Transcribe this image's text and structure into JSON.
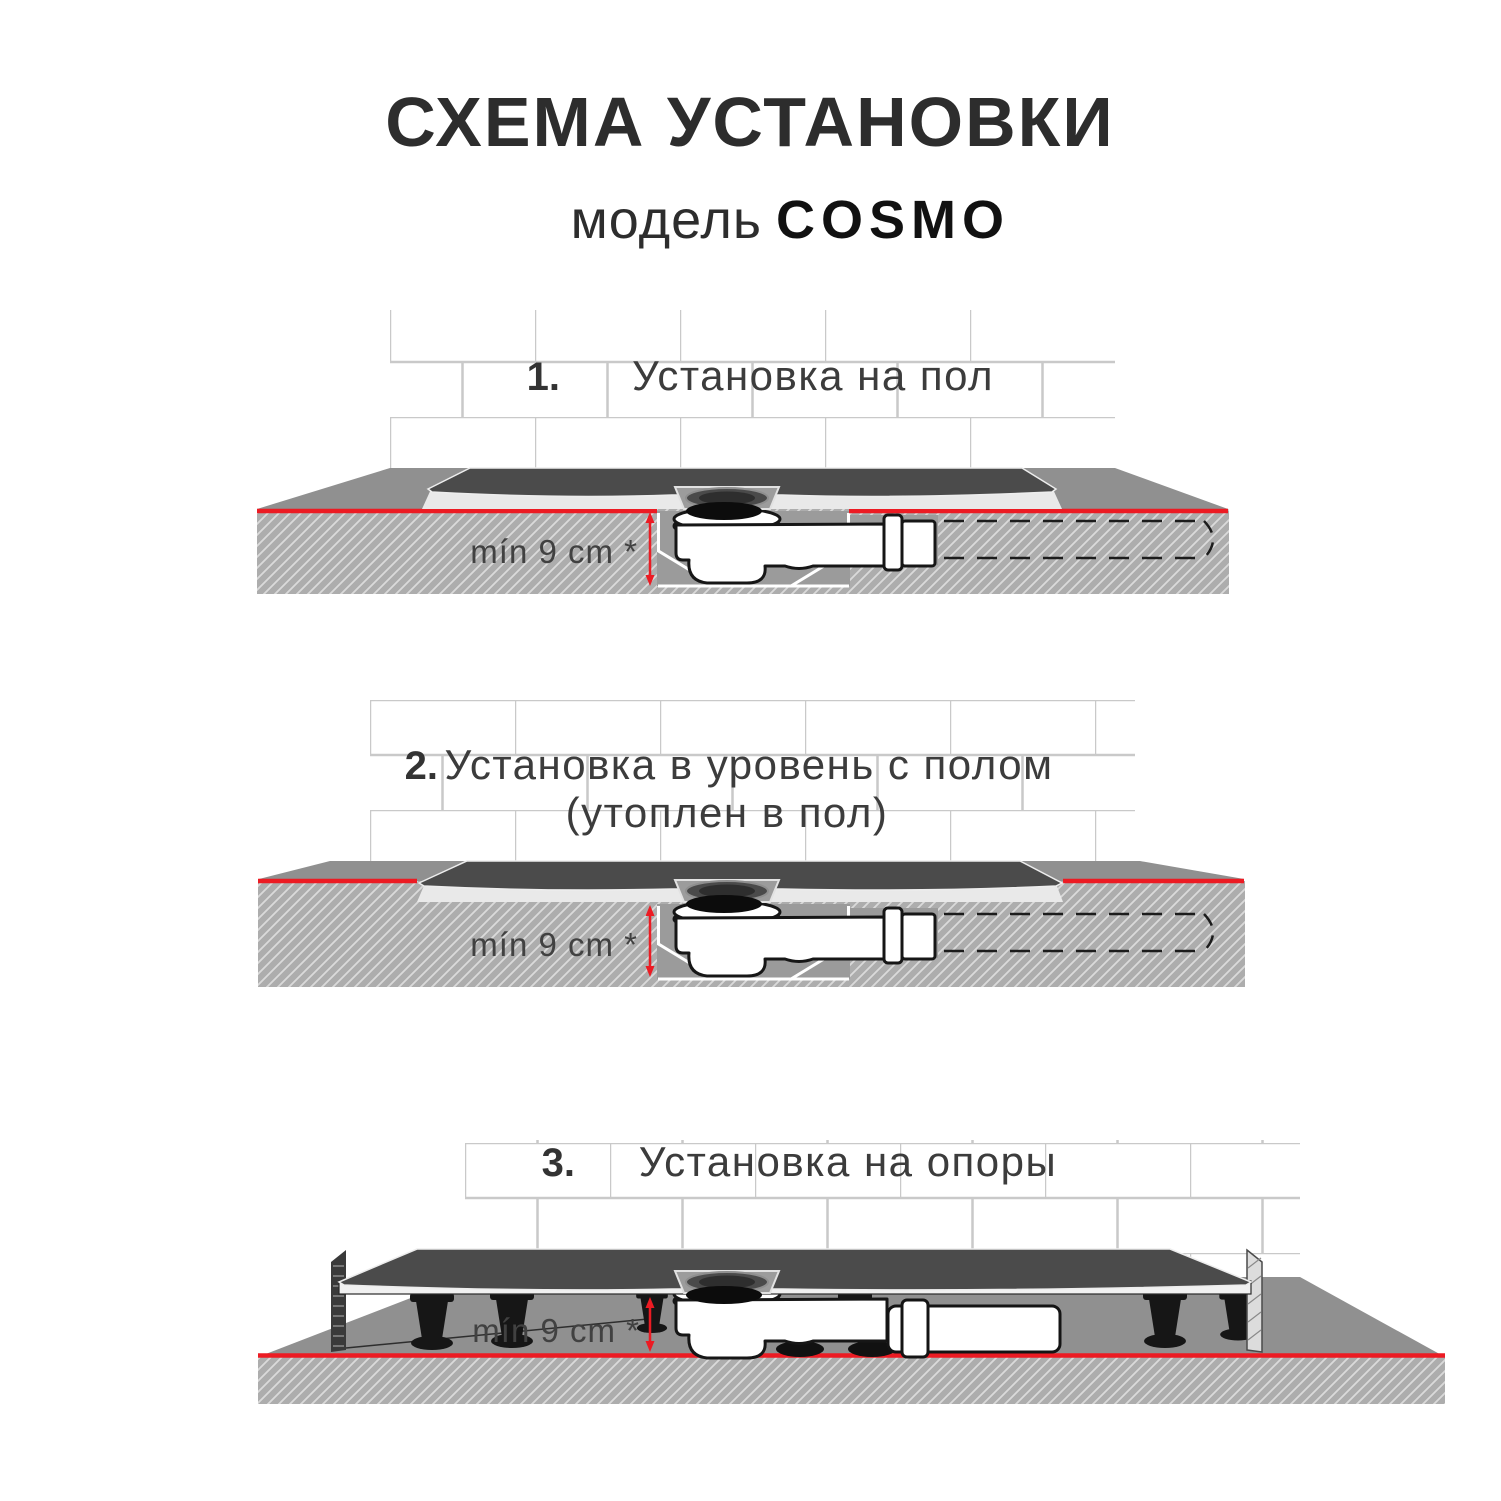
{
  "title": "СХЕМА УСТАНОВКИ",
  "subtitle": {
    "prefix": "модель",
    "model": "COSMO"
  },
  "dimension_label": "mín 9 cm *",
  "steps": [
    {
      "number": "1.",
      "title": "Установка на пол"
    },
    {
      "number": "2.",
      "title": "Установка в уровень с полом",
      "subtitle": "(утоплен в пол)"
    },
    {
      "number": "3.",
      "title": "Установка на опоры"
    }
  ],
  "colors": {
    "accent_red": "#ec1b23",
    "tray_top": "#4b4b4b",
    "tray_base": "#e9e9e9",
    "floor_surface": "#909090",
    "floor_slab": "#adadad",
    "recess": "#9b9b9b",
    "tile_grout": "#c9c9c9",
    "outline_dark": "#161616",
    "text_dark": "#2d2d2d",
    "text_body": "#3c3c3c"
  }
}
